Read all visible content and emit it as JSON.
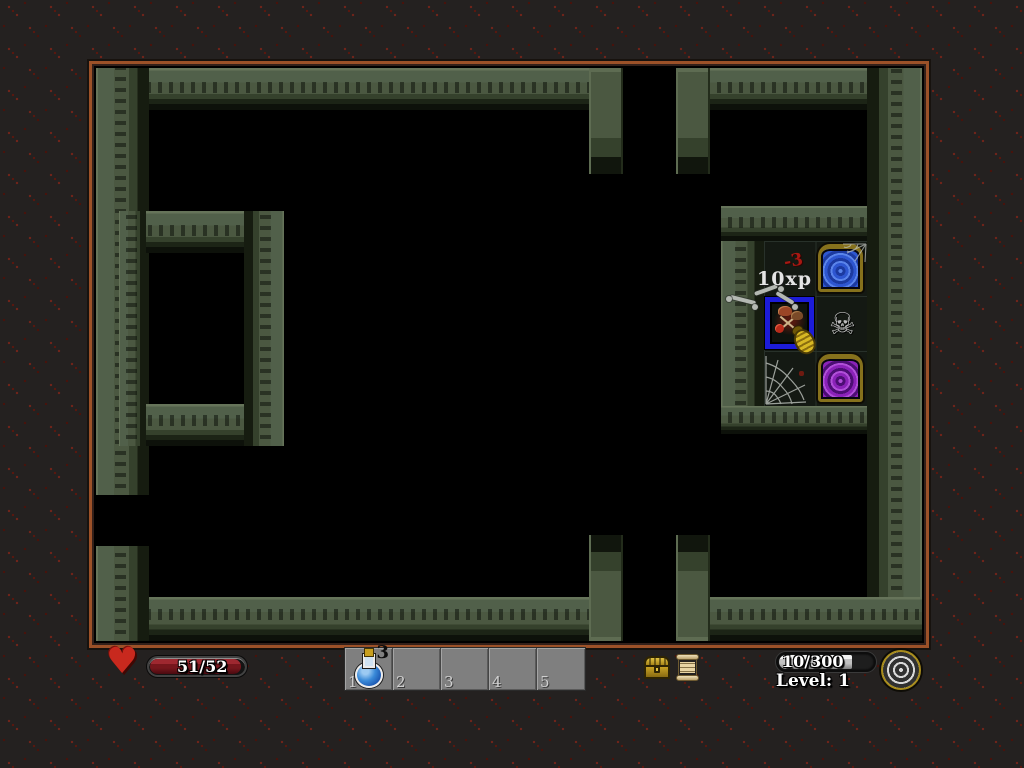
{
  "colors": {
    "background": "#242120",
    "background_dots": "#6e241a",
    "frame_copper": "#9c5128",
    "wall_green": "#4b5841",
    "health_red": "#76161c",
    "xp_silver": "#c2c2c2",
    "portal_blue": "#2e56d0",
    "portal_purple": "#8a22b8",
    "highlight_blue": "#1c1cd8",
    "gold": "#c8a820"
  },
  "icons": {
    "heart_glyph": "♥",
    "skull_glyph": "☠"
  },
  "room": {
    "floaters": {
      "xp": "10xp",
      "damage": "-3"
    }
  },
  "hud": {
    "health": {
      "value": "51/52"
    },
    "hotbar": {
      "slots": [
        {
          "number": "1",
          "item": "blue-potion",
          "count": "3"
        },
        {
          "number": "2"
        },
        {
          "number": "3"
        },
        {
          "number": "4"
        },
        {
          "number": "5"
        }
      ]
    },
    "xp": {
      "value": "10/300"
    },
    "level": {
      "label": "Level: 1"
    }
  }
}
